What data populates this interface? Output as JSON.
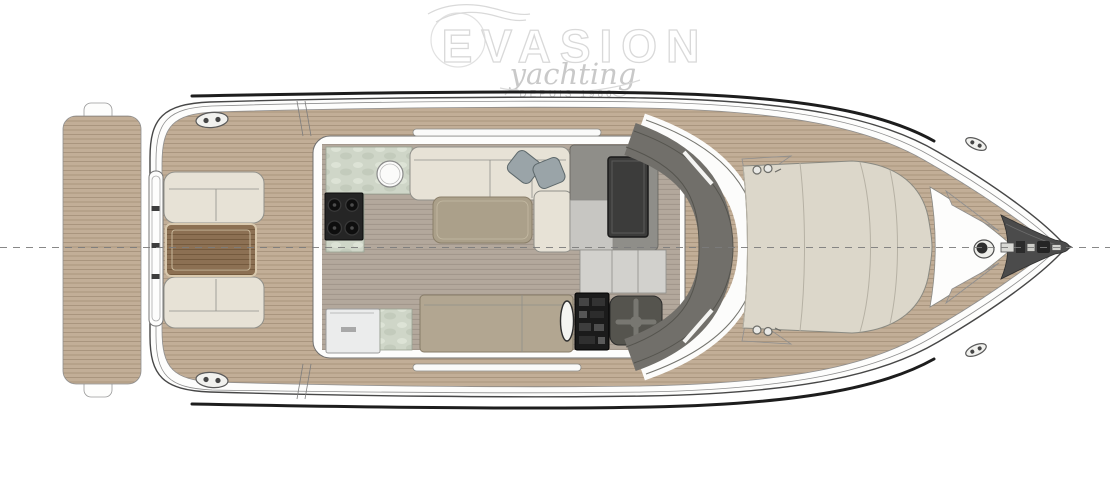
{
  "watermark": {
    "brand": "EVASION",
    "script": "yachting",
    "tagline": "DEPUIS 1986"
  },
  "colors": {
    "teak": "#c2ae97",
    "teak_stripe": "#a6927b",
    "floor": "#b3a89c",
    "floor_stripe": "#a0958a",
    "upholstery": "#e7e2d6",
    "upholstery_edge": "#90908a",
    "cockpit_table": "#8c7053",
    "cockpit_table_dark": "#6e5539",
    "cockpit_table_edge": "#d9c9ae",
    "salon_table": "#aba08a",
    "sideboard": "#b2a691",
    "marble": "#cfd6c8",
    "chair": "#9aa4a8",
    "dash": "#8f8e89",
    "dash_light": "#c7c6c2",
    "screen": "#3c3c3b",
    "steps": "#d2d1cd",
    "windshield": "#716f6a",
    "sunpad": "#dcd7ca",
    "sunpad_seam": "#b6b1a4",
    "bowsprit": "#4b4b4b",
    "hull_line": "#474747",
    "inner_line": "#8f8f8f",
    "strake": "#1d1d1d",
    "centerline": "#7c7c7c",
    "watermark_line": "#d9d9d9",
    "watermark_text": "#c9c9c9"
  }
}
